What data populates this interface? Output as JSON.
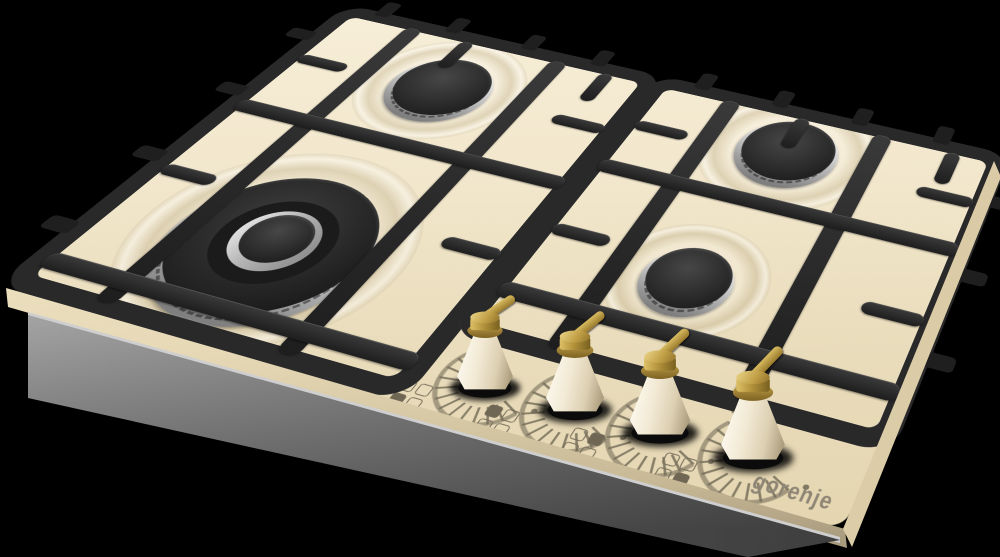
{
  "image_type": "3d-product-render",
  "product": {
    "brand": "gorenje",
    "category": "built-in gas hob",
    "finish": "ivory cream glass",
    "burner_count": 4,
    "grate_style": "two-piece cast-iron pan supports"
  },
  "logo": {
    "text": "gorenje",
    "color": "#8e8575"
  },
  "burners": [
    {
      "id": "b1",
      "name": "rear-left-burner",
      "size": "medium",
      "cap": "matte-black",
      "ring": "chrome"
    },
    {
      "id": "b2",
      "name": "front-left-burner",
      "size": "large-wok",
      "cap": "matte-black",
      "ring": "chrome"
    },
    {
      "id": "b3",
      "name": "rear-right-burner",
      "size": "medium",
      "cap": "matte-black",
      "ring": "chrome"
    },
    {
      "id": "b4",
      "name": "front-right-burner",
      "size": "small",
      "cap": "matte-black",
      "ring": "chrome"
    }
  ],
  "knobs": [
    {
      "id": "k1",
      "controls": "front-left-burner",
      "indicator_filled": "bottom-left",
      "body": "cream",
      "lever": "brass"
    },
    {
      "id": "k2",
      "controls": "rear-left-burner",
      "indicator_filled": "top-left",
      "body": "cream",
      "lever": "brass"
    },
    {
      "id": "k3",
      "controls": "rear-right-burner",
      "indicator_filled": "top-right",
      "body": "cream",
      "lever": "brass"
    },
    {
      "id": "k4",
      "controls": "front-right-burner",
      "indicator_filled": "bottom-right",
      "body": "cream",
      "lever": "brass"
    }
  ],
  "dial_print": {
    "tick_count": 13,
    "symbols": [
      "large-flame",
      "small-flame"
    ],
    "color": "#766e5a"
  },
  "colors": {
    "background": "#000000",
    "glass": "#f2e7cc",
    "glass_edge": "#e7d9b6",
    "base_metal": "#8f8f8f",
    "grate": "#292929",
    "chrome": "#c6c6c6",
    "burner_cap": "#2b2b2b",
    "brass": "#b3923c",
    "knob_body": "#f2e9d4",
    "print": "#8e8575"
  }
}
